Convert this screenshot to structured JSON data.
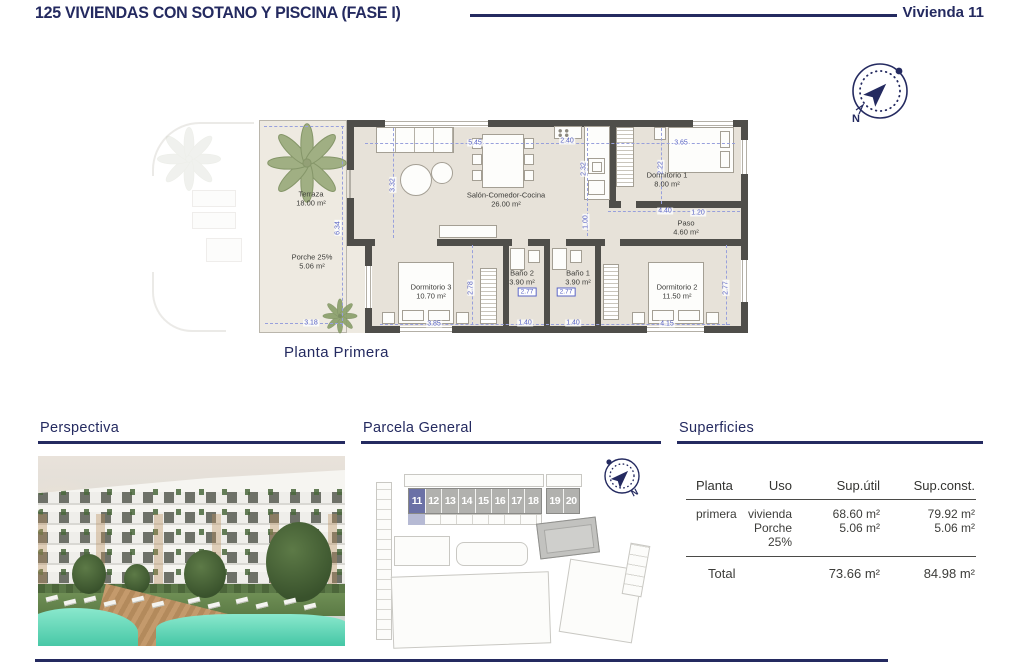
{
  "header": {
    "title": "125 VIVIENDAS CON SOTANO Y PISCINA (FASE I)",
    "unit": "Vivienda 11"
  },
  "compass": {
    "north": "N"
  },
  "floor_plan": {
    "caption": "Planta Primera",
    "rooms": {
      "terraza": {
        "name": "Terraza",
        "area": "18.00 m²"
      },
      "porche": {
        "name": "Porche 25%",
        "area": "5.06 m²"
      },
      "salon": {
        "name": "Salón-Comedor-Cocina",
        "area": "26.00 m²"
      },
      "dorm1": {
        "name": "Dormitorio 1",
        "area": "8.00 m²"
      },
      "paso": {
        "name": "Paso",
        "area": "4.60 m²"
      },
      "dorm3": {
        "name": "Dormitorio 3",
        "area": "10.70 m²"
      },
      "bano2": {
        "name": "Baño 2",
        "area": "3.90 m²"
      },
      "bano1": {
        "name": "Baño 1",
        "area": "3.90 m²"
      },
      "dorm2": {
        "name": "Dormitorio 2",
        "area": "11.50 m²"
      }
    },
    "dims": {
      "salon_w": "5.45",
      "kitchen_w": "2.40",
      "dorm1_w": "3.65",
      "salon_h": "3.32",
      "kitchen_h": "2.32",
      "dorm1_h": "2.22",
      "paso_w": "4.40",
      "paso_w2": "1.20",
      "kitchen_b": "1.00",
      "terraza_h": "6.34",
      "terraza_w": "3.18",
      "dorm3_h": "2.78",
      "dorm3_w": "3.85",
      "bano2_w": "1.40",
      "bano1_w": "1.40",
      "bano2_d": "2.77",
      "bano1_d": "2.77",
      "dorm2_w": "4.15",
      "dorm2_h": "2.77"
    }
  },
  "sections": {
    "perspectiva": "Perspectiva",
    "parcela": "Parcela General",
    "superficies": "Superficies"
  },
  "site_plan": {
    "units": [
      "11",
      "12",
      "13",
      "14",
      "15",
      "16",
      "17",
      "18",
      "19",
      "20"
    ],
    "highlighted_unit": "11"
  },
  "table": {
    "headers": [
      "Planta",
      "Uso",
      "Sup.útil",
      "Sup.const."
    ],
    "rows": [
      {
        "planta": "primera",
        "uso": "vivienda",
        "util": "68.60 m²",
        "const": "79.92 m²"
      },
      {
        "planta": "",
        "uso": "Porche 25%",
        "util": "5.06 m²",
        "const": "5.06 m²"
      }
    ],
    "total": {
      "label": "Total",
      "util": "73.66 m²",
      "const": "84.98 m²"
    }
  }
}
